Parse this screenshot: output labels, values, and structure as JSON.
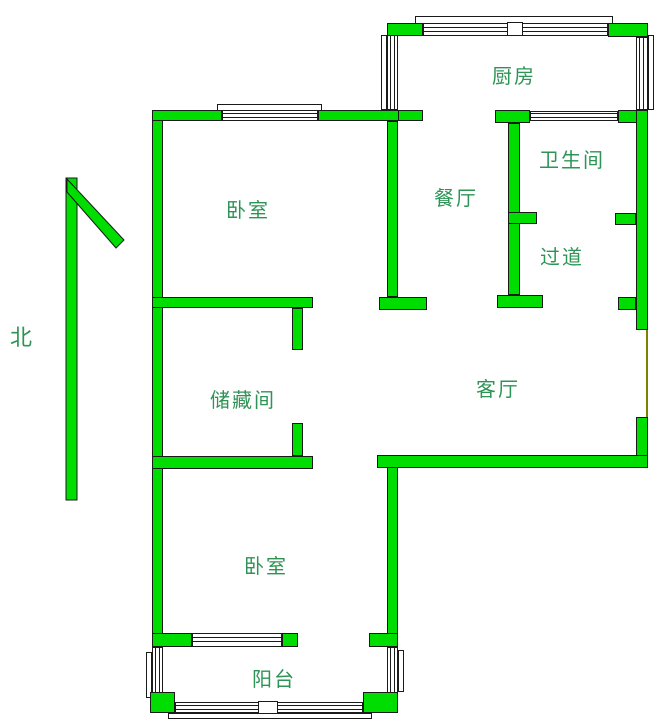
{
  "plan": {
    "compass_label": "北",
    "rooms": [
      {
        "name": "kitchen",
        "label": "厨房"
      },
      {
        "name": "bathroom",
        "label": "卫生间"
      },
      {
        "name": "dining-room",
        "label": "餐厅"
      },
      {
        "name": "hallway",
        "label": "过道"
      },
      {
        "name": "bedroom-north",
        "label": "卧室"
      },
      {
        "name": "storage-room",
        "label": "储藏间"
      },
      {
        "name": "living-room",
        "label": "客厅"
      },
      {
        "name": "bedroom-south",
        "label": "卧室"
      },
      {
        "name": "balcony",
        "label": "阳台"
      }
    ],
    "colors": {
      "background": "#ffffff",
      "wall": "#00dd00",
      "wall_outline": "#1a1a1a",
      "label_text": "#2e9455",
      "opening_marker": "#808000"
    }
  }
}
